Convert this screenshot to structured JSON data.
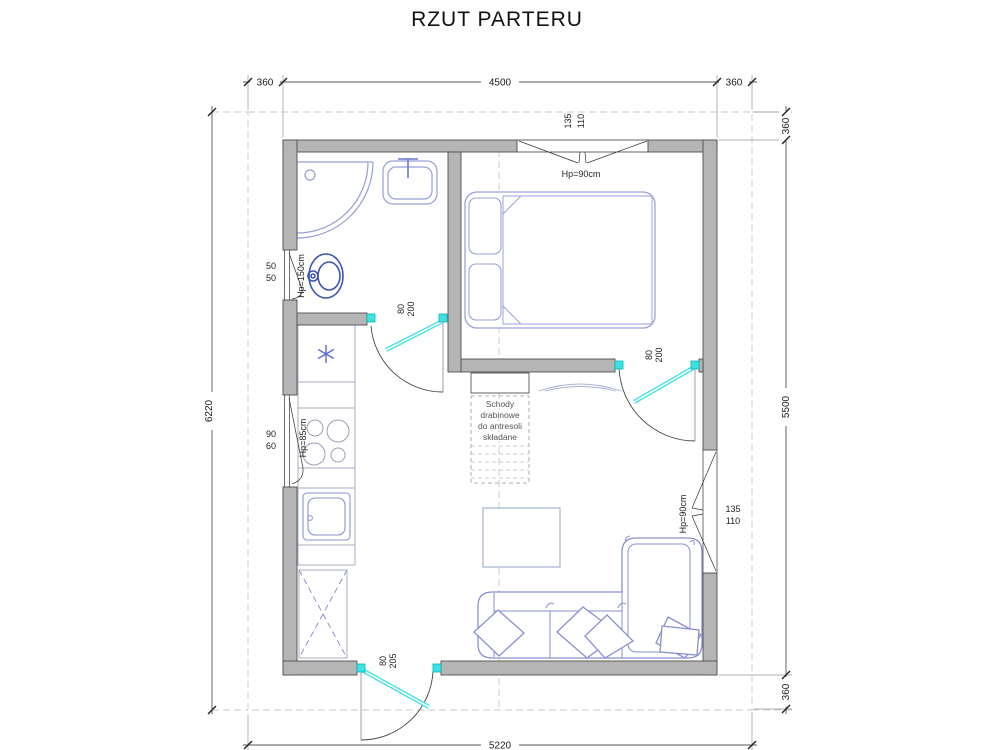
{
  "title": "RZUT PARTERU",
  "dims": {
    "top_left": "360",
    "top_mid": "4500",
    "top_right": "360",
    "left": "6220",
    "right_top": "360",
    "right_mid": "5500",
    "right_bottom": "360",
    "bottom": "5220"
  },
  "windows": {
    "bedroom": {
      "dim1": "135",
      "dim2": "110",
      "sill": "Hp=90cm"
    },
    "living": {
      "dim1": "135",
      "dim2": "110",
      "sill": "Hp=90cm"
    },
    "bathroom": {
      "dim1": "50",
      "dim2": "50",
      "sill": "Hp=150cm"
    },
    "kitchen": {
      "dim1": "90",
      "dim2": "60",
      "sill": "Hp=85cm"
    }
  },
  "doors": {
    "bathroom": {
      "dim1": "80",
      "dim2": "200"
    },
    "bedroom": {
      "dim1": "80",
      "dim2": "200"
    },
    "entrance": {
      "dim1": "80",
      "dim2": "205"
    }
  },
  "notes": {
    "ladder": {
      "line1": "Schody",
      "line2": "drabinowe",
      "line3": "do antresoli",
      "line4": "składane"
    }
  },
  "colors": {
    "wall": "#b5b5b5",
    "furniture": "#8891cf",
    "fixture": "#3d52bb",
    "door_window_marker": "#3ae2e2",
    "dimension": "#555555"
  }
}
